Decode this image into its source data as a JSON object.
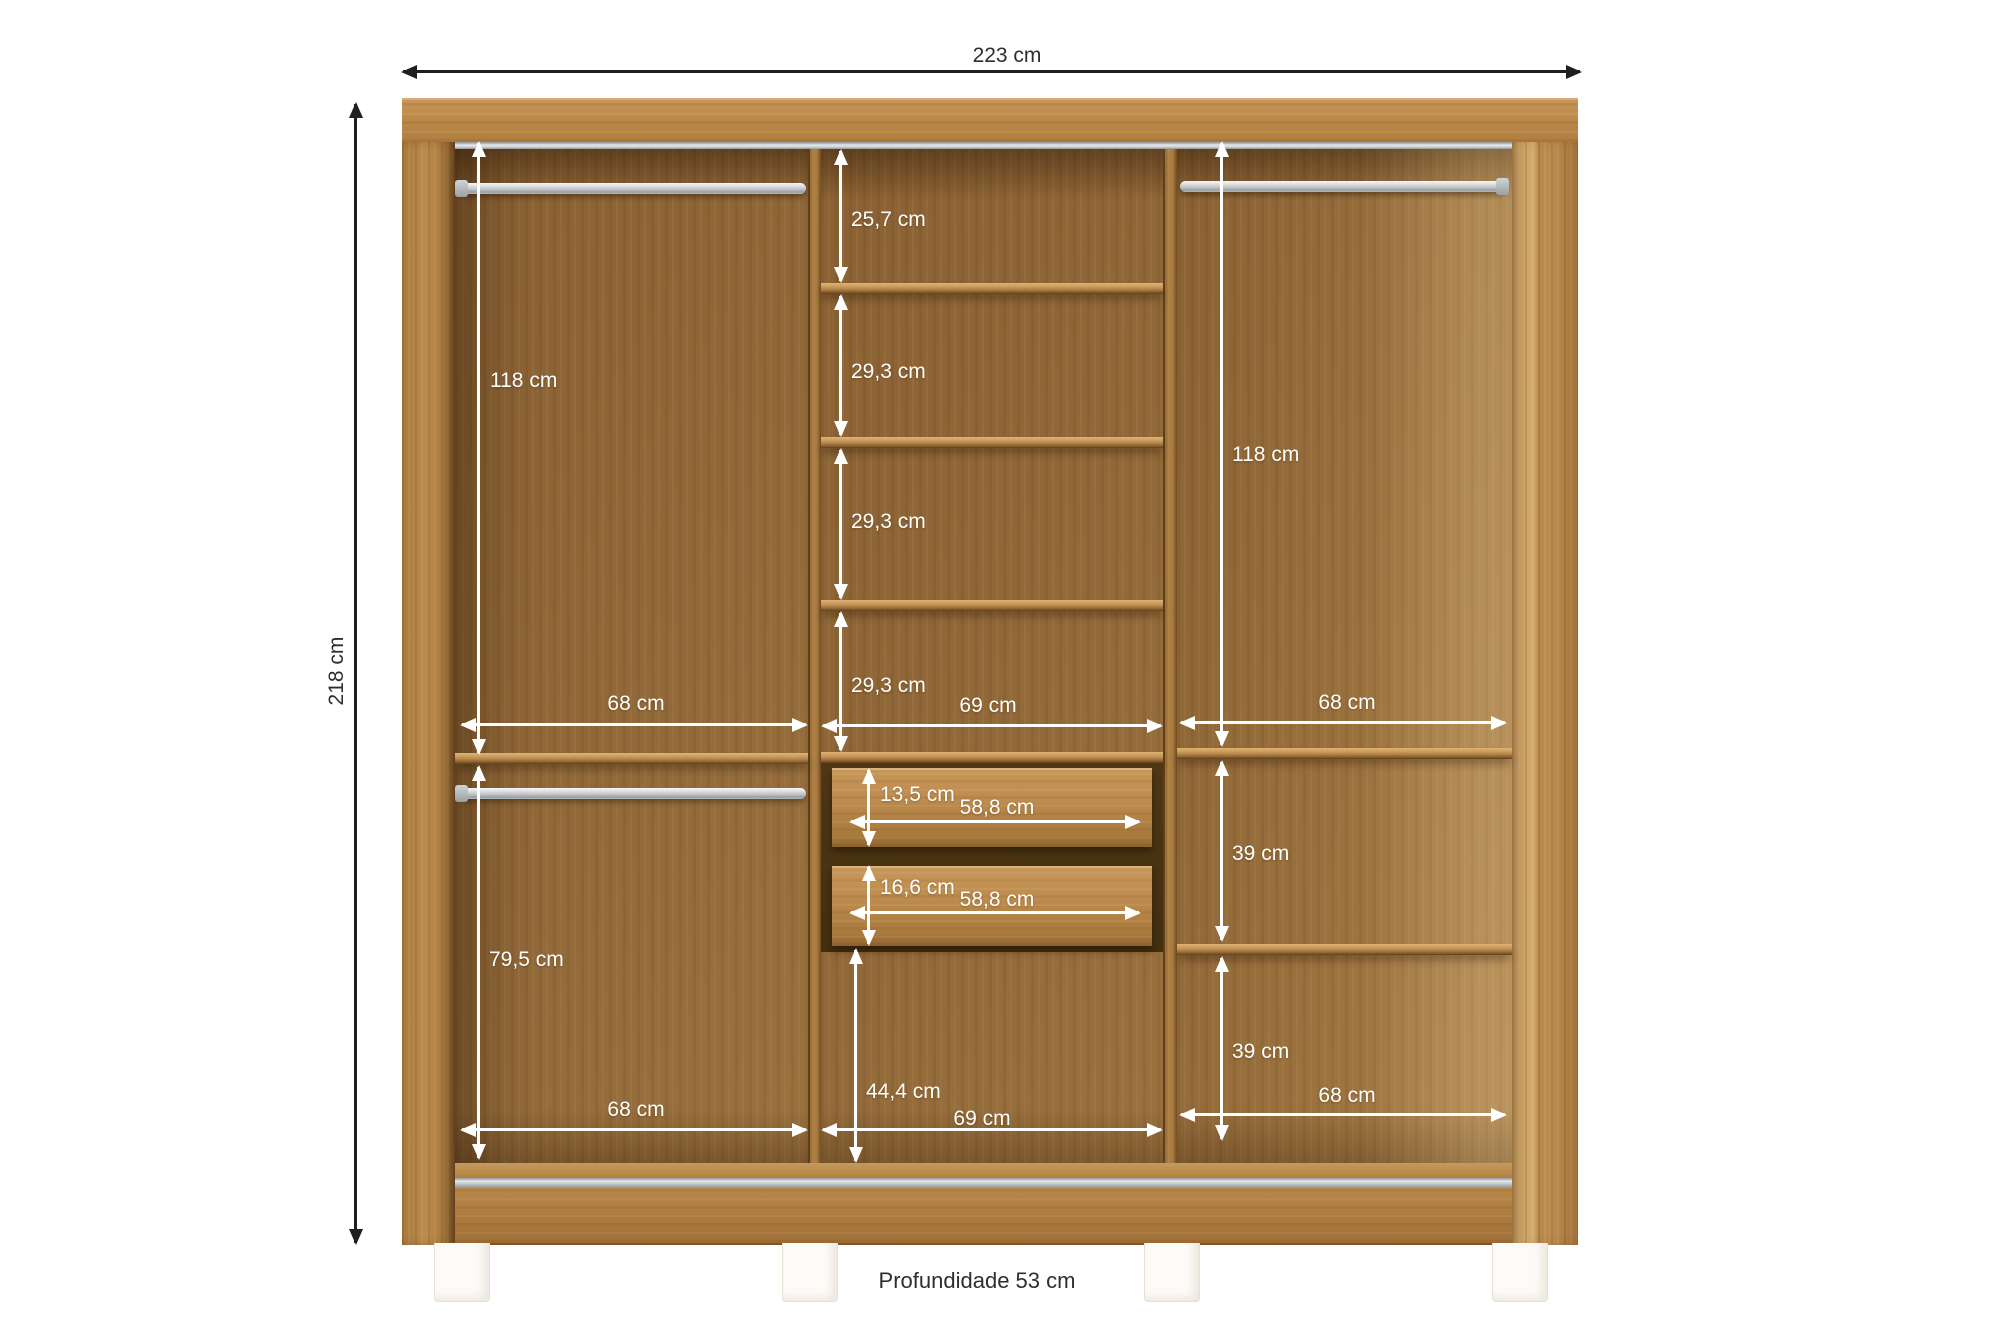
{
  "colors": {
    "background": "#ffffff",
    "wood_frame": "#b5813f",
    "wood_interior": "#8f6736",
    "chrome": "#d6d9da",
    "dimension_inner": "#ffffff",
    "dimension_outer": "#1f1f1f"
  },
  "overall": {
    "width": "223 cm",
    "height": "218 cm",
    "depth": "Profundidade 53 cm"
  },
  "left_section": {
    "hanging_height": "118 cm",
    "upper_width": "68 cm",
    "lower_height": "79,5 cm",
    "lower_width": "68 cm"
  },
  "middle_section": {
    "compartment_1_height": "25,7 cm",
    "compartment_2_height": "29,3 cm",
    "compartment_3_height": "29,3 cm",
    "compartment_4_height": "29,3 cm",
    "upper_width": "69 cm",
    "drawer_1_height": "13,5 cm",
    "drawer_1_width": "58,8 cm",
    "drawer_2_height": "16,6 cm",
    "drawer_2_width": "58,8 cm",
    "lower_height": "44,4 cm",
    "lower_width": "69 cm"
  },
  "right_section": {
    "hanging_height": "118 cm",
    "upper_width": "68 cm",
    "upper_shelf_height": "39 cm",
    "lower_shelf_height": "39 cm",
    "lower_width": "68 cm"
  }
}
